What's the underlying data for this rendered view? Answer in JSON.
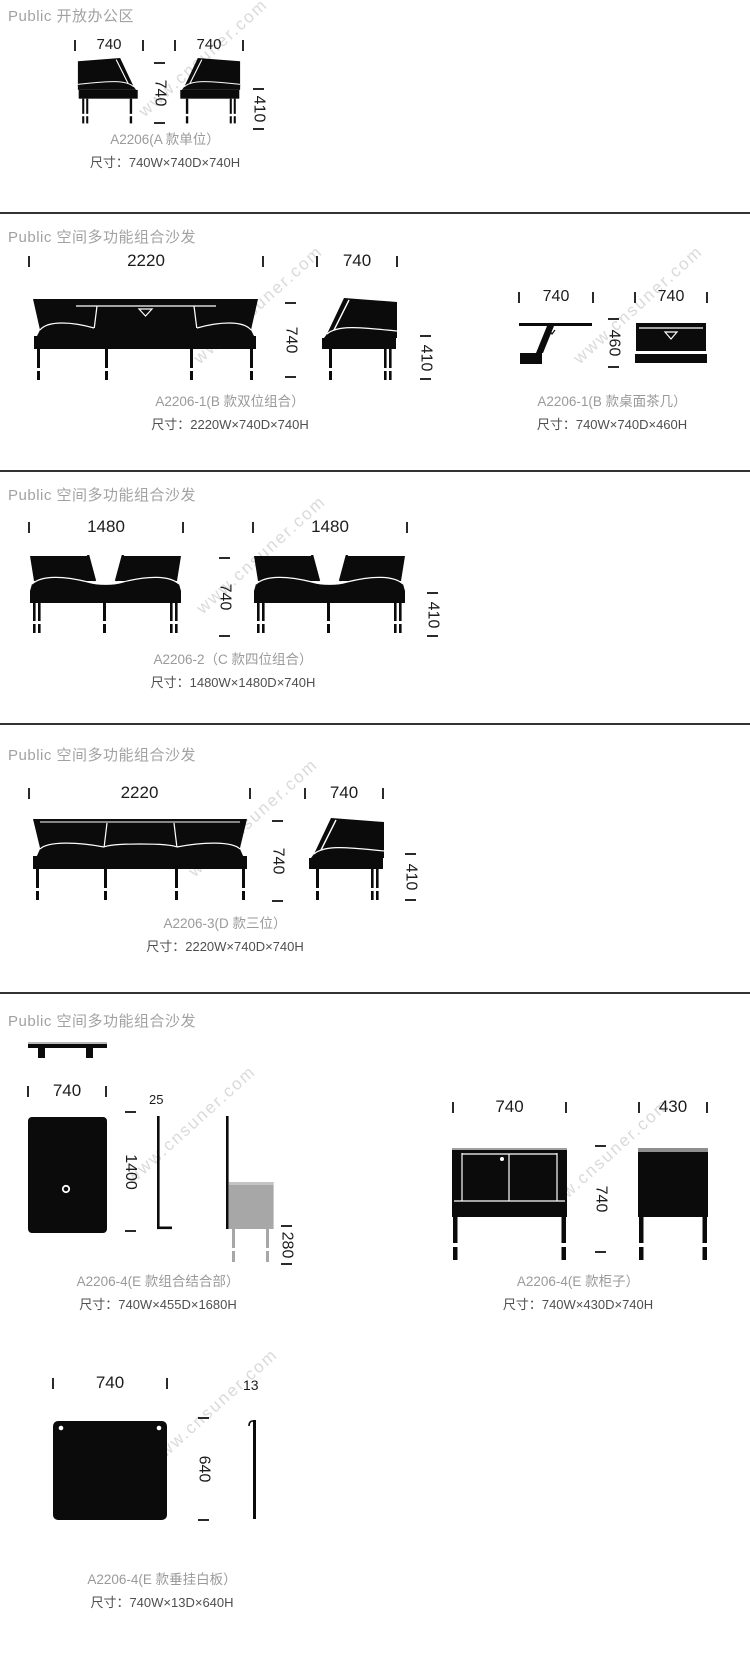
{
  "watermark": "www.cnsuner.com",
  "s1": {
    "header": "Public 开放办公区",
    "dim_front_w": "740",
    "dim_side_w": "740",
    "dim_depth": "740",
    "dim_height": "410",
    "caption": "A2206(A 款单位）",
    "size": "尺寸：740W×740D×740H"
  },
  "s2": {
    "header": "Public 空间多功能组合沙发",
    "sofa": {
      "dim_w": "2220",
      "dim_depth": "740",
      "dim_side_w": "740",
      "dim_height": "410",
      "caption": "A2206-1(B 款双位组合）",
      "size": "尺寸：2220W×740D×740H"
    },
    "table": {
      "dim_side_w": "740",
      "dim_h": "460",
      "dim_front_w": "740",
      "caption": "A2206-1(B 款桌面茶几）",
      "size": "尺寸：740W×740D×460H"
    }
  },
  "s3": {
    "header": "Public 空间多功能组合沙发",
    "dim_left_w": "1480",
    "dim_right_w": "1480",
    "dim_depth": "740",
    "dim_height": "410",
    "caption": "A2206-2（C 款四位组合）",
    "size": "尺寸：1480W×1480D×740H"
  },
  "s4": {
    "header": "Public 空间多功能组合沙发",
    "dim_w": "2220",
    "dim_depth": "740",
    "dim_side_w": "740",
    "dim_height": "410",
    "caption": "A2206-3(D 款三位）",
    "size": "尺寸：2220W×740D×740H"
  },
  "s5": {
    "header": "Public 空间多功能组合沙发",
    "combo": {
      "dim_w": "740",
      "dim_pole_t": "25",
      "dim_pole_h": "1400",
      "dim_box_h": "280",
      "caption": "A2206-4(E 款组合结合部）",
      "size": "尺寸：740W×455D×1680H"
    },
    "cabinet": {
      "dim_w": "740",
      "dim_d": "430",
      "dim_h": "740",
      "caption": "A2206-4(E 款柜子）",
      "size": "尺寸：740W×430D×740H"
    },
    "board": {
      "dim_w": "740",
      "dim_t": "13",
      "dim_h": "640",
      "caption": "A2206-4(E 款垂挂白板）",
      "size": "尺寸：740W×13D×640H"
    }
  }
}
